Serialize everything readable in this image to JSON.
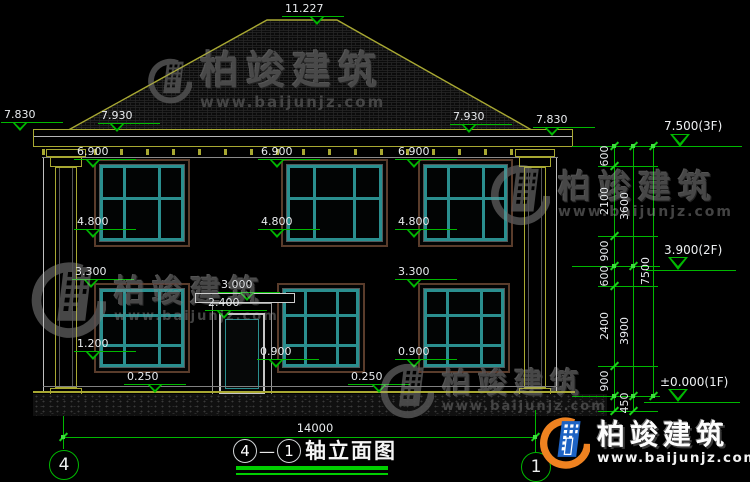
{
  "meta": {
    "drawing_title": "轴立面图",
    "title_separator": "—"
  },
  "axes": {
    "left": "4",
    "right": "1"
  },
  "brand": {
    "name": "柏竣建筑",
    "url": "www.baijunjz.com"
  },
  "levels": {
    "ridge": "11.227",
    "eave_outer_left": "7.830",
    "roof_left": "7.930",
    "roof_right": "7.930",
    "eave_outer_right": "7.830",
    "f3": "7.500(3F)",
    "f2": "3.900(2F)",
    "f1": "±0.000(1F)",
    "win2f_head": [
      "6.900",
      "6.900",
      "6.900"
    ],
    "win2f_sill": [
      "4.800",
      "4.800",
      "4.800"
    ],
    "win1f_head": [
      "3.300",
      "3.300"
    ],
    "canopy": "3.000",
    "door_head": "2.400",
    "win1f_sill_left": "1.200",
    "win1f_sill": [
      "0.900",
      "0.900"
    ],
    "plinth": [
      "0.250",
      "0.250"
    ]
  },
  "dims": {
    "total_width": "14000",
    "chain_inner": [
      "600",
      "2100",
      "900",
      "600",
      "2400",
      "900"
    ],
    "chain_mid": [
      "3600",
      "3900",
      "450"
    ],
    "chain_outer": [
      "7500"
    ]
  },
  "colors": {
    "dim_green": "#00b800",
    "cad_yellow": "#a8a832",
    "window_teal": "#2a8f8f",
    "trim_brown": "#5a3c2b",
    "logo_orange": "#ef8220",
    "logo_blue": "#1e63c4"
  }
}
